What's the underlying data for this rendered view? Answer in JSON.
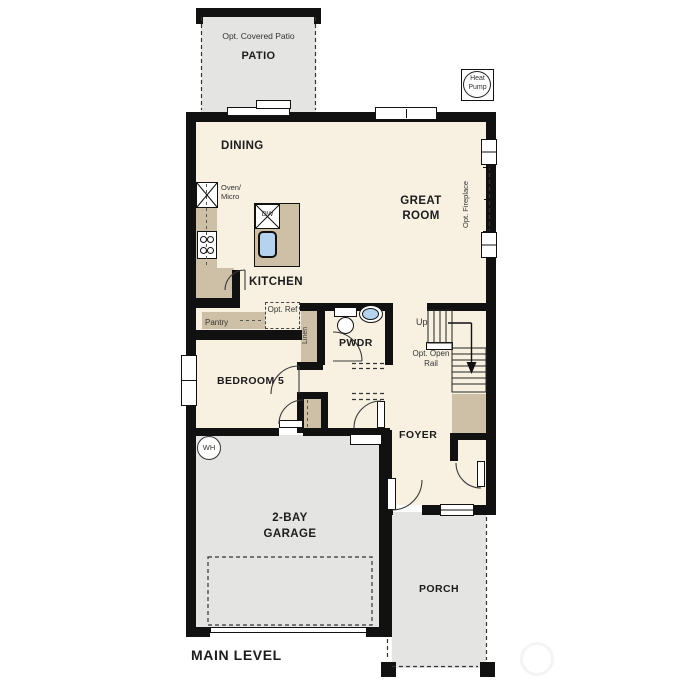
{
  "title": "MAIN LEVEL",
  "colors": {
    "wall": "#111111",
    "floor": "#f8f1e2",
    "concrete": "#e4e4e2",
    "counter": "#cdc0a6",
    "sink_blue": "#b5d3ee"
  },
  "rooms": {
    "patio": {
      "optional": "Opt. Covered Patio",
      "name": "PATIO"
    },
    "dining": "DINING",
    "great_room": "GREAT ROOM",
    "kitchen": "KITCHEN",
    "bedroom5": "BEDROOM 5",
    "powder": "PWDR",
    "foyer": "FOYER",
    "garage": "2-BAY GARAGE",
    "porch": "PORCH"
  },
  "fixtures": {
    "oven_micro": "Oven/ Micro",
    "dishwasher": "DW",
    "pantry": "Pantry",
    "opt_ref": "Opt. Ref",
    "linen": "Linen",
    "water_heater": "WH",
    "heat_pump": "Heat Pump"
  },
  "stairs": {
    "up": "Up",
    "open_rail": "Opt. Open Rail"
  },
  "annotations": {
    "fireplace": "Opt. Fireplace"
  }
}
